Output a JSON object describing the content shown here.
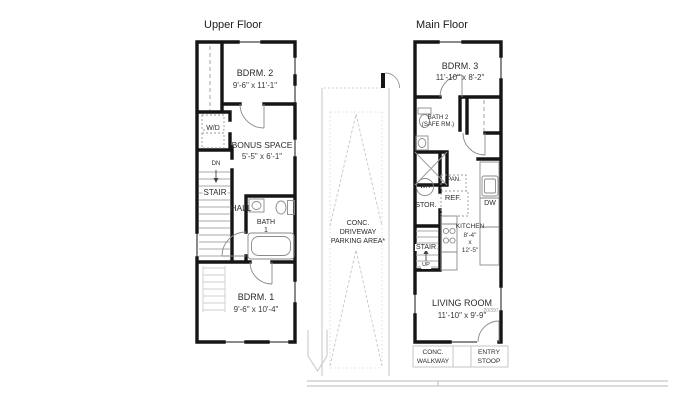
{
  "upper_floor": {
    "title": "Upper Floor",
    "bdrm2": {
      "name": "BDRM. 2",
      "dims": "9'-6\" x 11'-1\""
    },
    "wd": "W/D",
    "bonus": {
      "name": "BONUS SPACE",
      "dims": "5'-5\" x 6'-1\""
    },
    "dn": "DN",
    "stair": "STAIR",
    "hall": "HALL",
    "bath1_line1": "BATH",
    "bath1_line2": "1",
    "bdrm1": {
      "name": "BDRM. 1",
      "dims": "9'-6\" x 10'-4\""
    }
  },
  "driveway": {
    "line1": "CONC.",
    "line2": "DRIVEWAY",
    "line3": "PARKING AREA*"
  },
  "main_floor": {
    "title": "Main Floor",
    "bdrm3": {
      "name": "BDRM. 3",
      "dims": "11'-10\" x 8'-2\""
    },
    "bath2_line1": "BATH 2",
    "bath2_line2": "(SAFE RM.)",
    "wh": "WH",
    "pan": "PAN.",
    "ref": "REF.",
    "stor": "STOR.",
    "stair": "STAIR",
    "up": "UP",
    "kitchen": {
      "name": "KITCHEN",
      "dim1": "8'-4\"",
      "dim2": "x",
      "dim3": "12'-5\""
    },
    "dw": "DW",
    "living": {
      "name": "LIVING ROOM",
      "dims": "11'-10\" x 9'-9\""
    },
    "entry_door_tag": "20/397",
    "walkway_line1": "CONC.",
    "walkway_line2": "WALKWAY",
    "stoop_line1": "ENTRY",
    "stoop_line2": "STOOP"
  },
  "colors": {
    "wall": "#151515",
    "fixture": "#8a8a8a",
    "light": "#c6c6c6",
    "text": "#2b2b2b"
  }
}
